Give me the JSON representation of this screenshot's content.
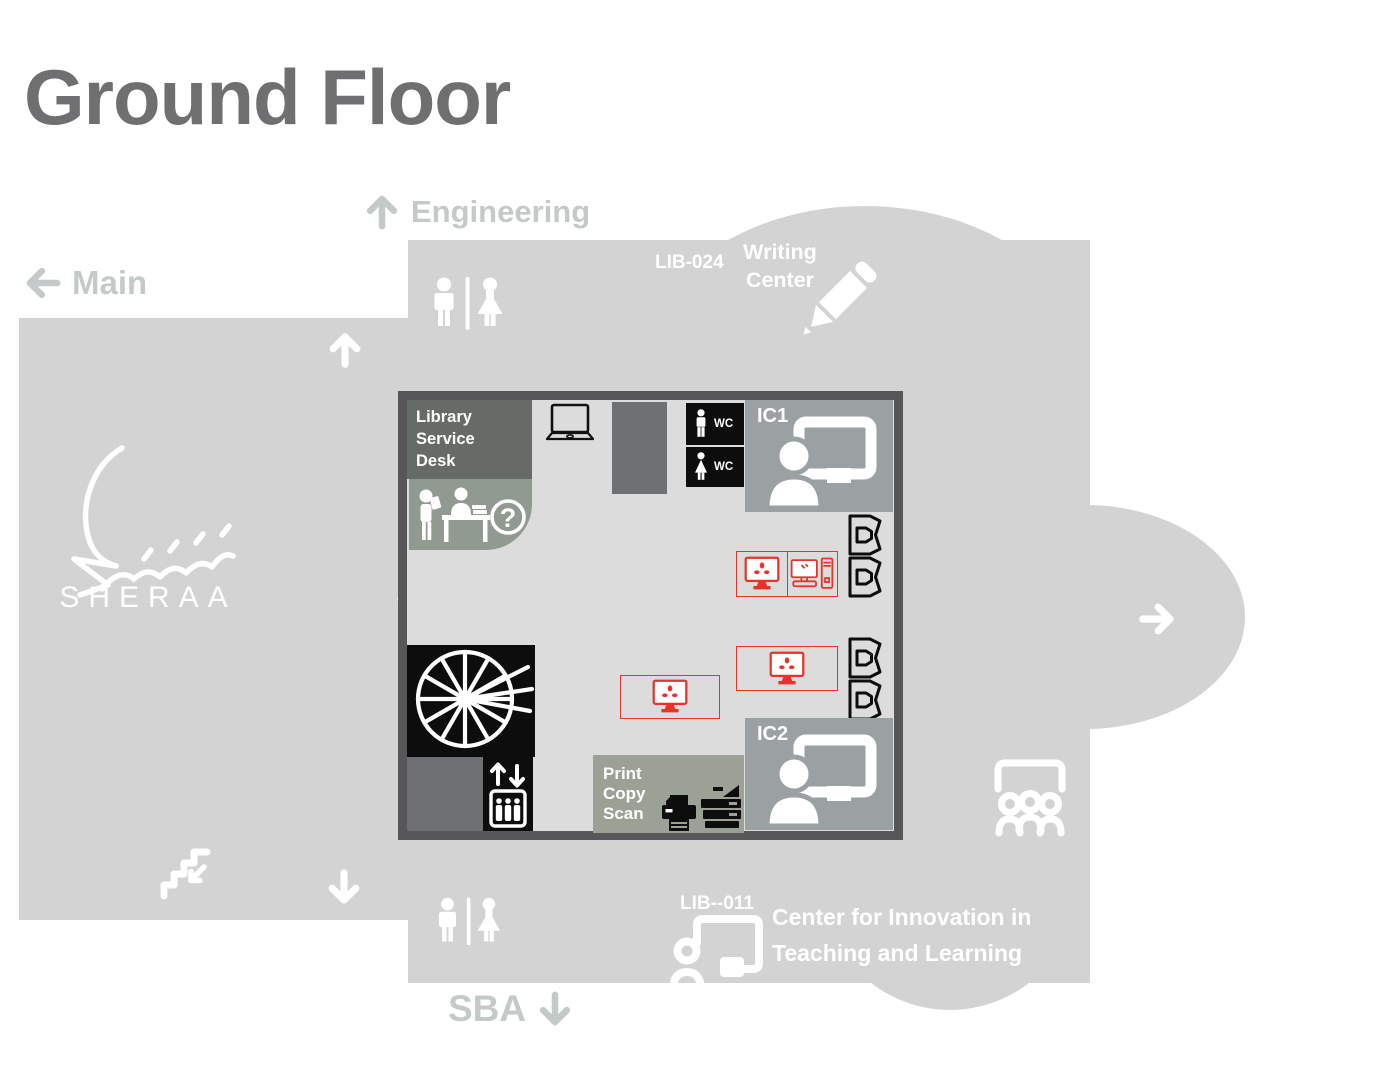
{
  "title": "Ground Floor",
  "nav": {
    "engineering": "Engineering",
    "main": "Main",
    "sba": "SBA"
  },
  "writing_center": {
    "code": "LIB-024",
    "name": "Writing Center"
  },
  "room": {
    "service_desk": "Library Service Desk",
    "wc": "WC",
    "ic1": "IC1",
    "ic2": "IC2",
    "print_copy_scan": "Print Copy Scan"
  },
  "citl": {
    "code": "LIB--011",
    "name": "Center for Innovation in Teaching and Learning"
  },
  "logo": {
    "text": "SHERAA"
  },
  "glyphs": {
    "question_mark": "?"
  },
  "colors": {
    "building": "#d3d3d3",
    "room-fill": "#dcdcdc",
    "room-border": "#57575a",
    "dark-box": "#676b67",
    "pillar": "#6f7073",
    "ic-box": "#9ba1a2",
    "desk-box": "#909a90",
    "print-box": "#9ba295",
    "accent-red": "#e8322a",
    "label-light": "#c4cac9",
    "title-grey": "#6f6f71",
    "black": "#0d0d0d",
    "white": "#ffffff"
  }
}
